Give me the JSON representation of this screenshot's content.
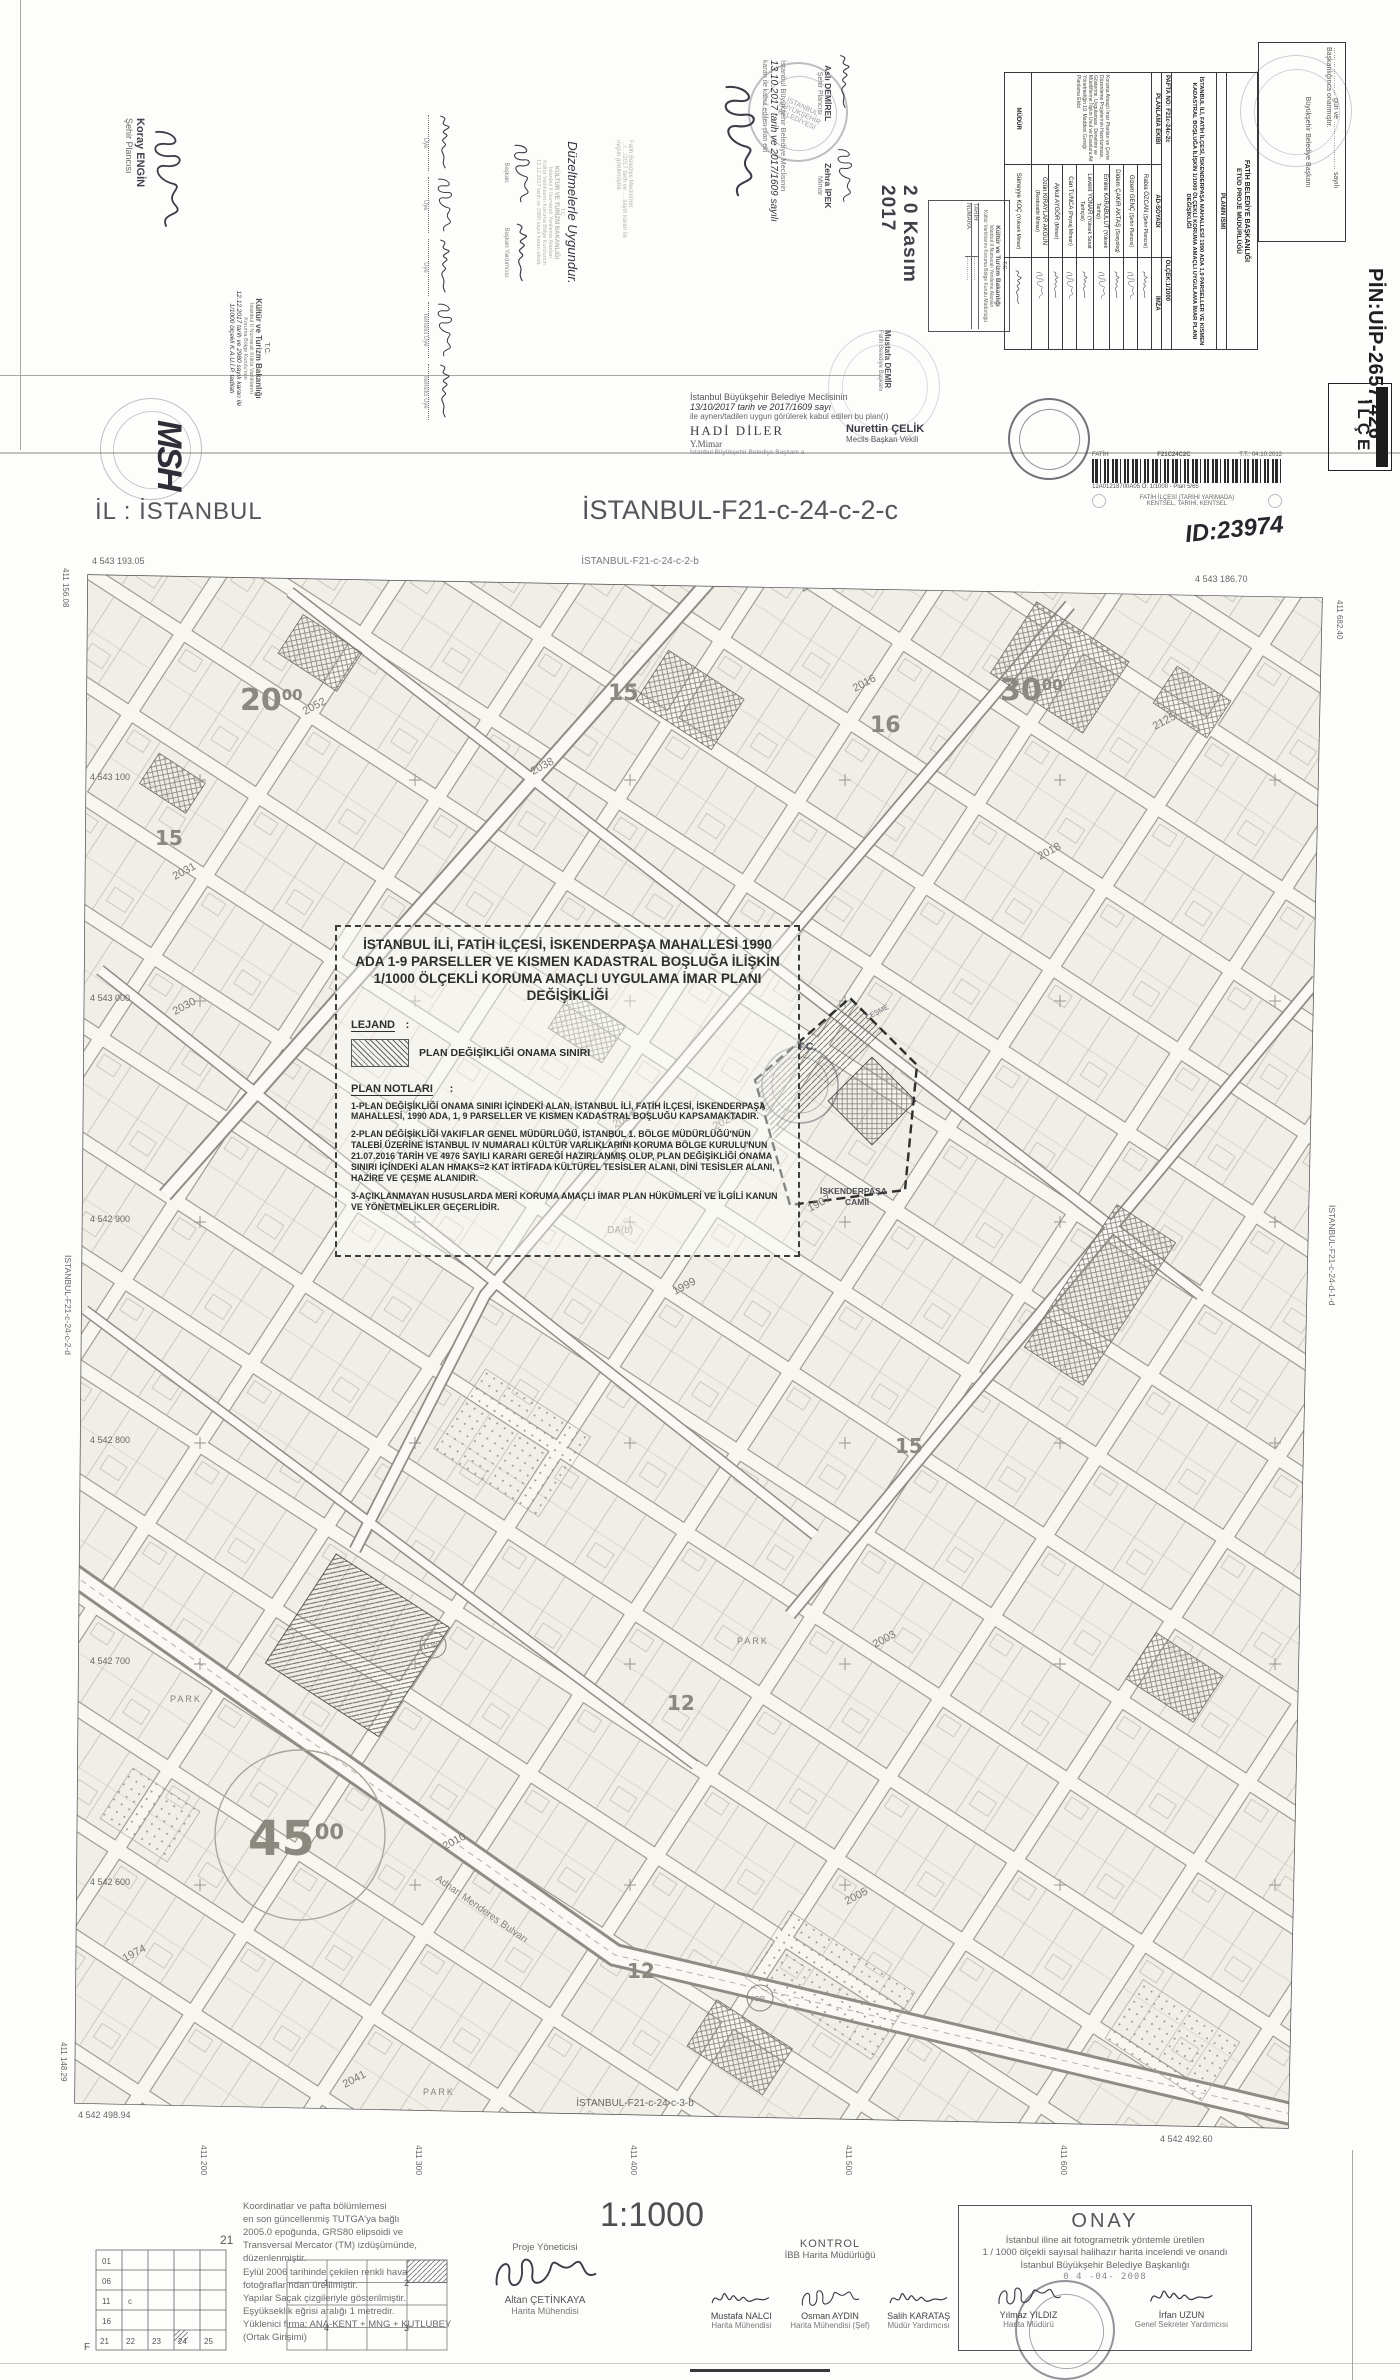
{
  "accent": {
    "ink": "#3c3c48",
    "stamp_gray": "#6b6b78",
    "line": "#444444"
  },
  "top_left": {
    "koray_name": "Koray ENGİN",
    "koray_title": "Şehir Plancısı",
    "monogram": "MSH",
    "kultur": {
      "tc": "T.C.",
      "l1": "Kültür ve Turizm Bakanlığı",
      "l2": "İstanbul II Numaralı Kültür Varlıklarını",
      "l3": "Koruma Bölge Kurulu'nun",
      "hand1": "12.12.2017 tarih ve 2980 sayılı kararı ile",
      "hand2": "1/1000 ölçekli K.A.U.İ.P. tadilatı"
    },
    "uye_labels": [
      "Üye",
      "Üye",
      "Üye",
      "Temsilci Üye",
      "Temsilci Üye"
    ],
    "duzeltme": {
      "hand": "Düzeltmelerle Uygundur.",
      "s1": "T.C.",
      "s2": "KÜLTÜR VE TURİZM BAKANLIĞI",
      "s3": "İstanbul II Numaralı Yenileme Alanları",
      "s4": "Kültür Varlıklarını Koruma Bölge Kurulunun",
      "s5": "12.12.2017 tarih ve 2980 sayılı kararı ekidir.",
      "sig1": "Başkan",
      "sig2": "Başkan Yardımcısı"
    },
    "fatih_faint": [
      "Fatih Belediye Meclisi'nin",
      "…/…/2017 tarih ve … sayılı kararı ile",
      "uygun görülmüştür."
    ]
  },
  "center_stamps": {
    "ibb1": "İstanbul Büyükşehir Belediye Meclisinin",
    "ibb2": "13.10.2017 tarih ve 2017/1609 sayılı",
    "ibb3": "kararı ile kabul edilen plan eki",
    "ibb_round": "İSTANBUL BÜYÜKŞEHİR BELEDİYESİ",
    "asli_name": "Aslı DEMİREL",
    "asli_title": "Şehir Plancısı",
    "zehra_name": "Zehra İPEK",
    "zehra_title": "Mimar",
    "date_stamp": "2 0 Kasım 2017",
    "kurul_box": {
      "tc": "T.C.",
      "l1": "Kültür ve Turizm Bakanlığı",
      "l2": "İstanbul II Numaralı Yenileme Alanları",
      "l3": "Kültür Varlıklarını Koruma Bölge Kurulu Müdürlüğü",
      "tarih": "TARİH",
      "numara": "NUMARA"
    },
    "mustafa": "Mustafa DEMİR",
    "mustafa_title": "Fatih Belediye Başkanı",
    "below_fold": {
      "l1": "İstanbul Büyükşehir Belediye Meclisinin",
      "l2": "13/10/2017 tarih ve 2017/1609 sayı",
      "l3": "ile aynen/tadilen uygun görülerek kabul edilen bu plan(ı)",
      "name1": "HADİ DİLER",
      "title1": "Y.Mimar",
      "sub1": "İstanbul Büyükşehir Belediye Başkanı a.",
      "name2": "Nurettin ÇELİK",
      "title2": "Meclis Başkan Vekili"
    }
  },
  "top_right": {
    "onama_box": {
      "l1": "………………… gün ve ………………… sayılı",
      "l2": "Başkanlığınca onanmıştır.",
      "l3": "Büyükşehir Belediye Başkanı"
    },
    "pin": "PİN:UİP-2657,426",
    "ilce": "İLÇE",
    "barcode": {
      "left": "FATİH",
      "code": "F21C24C2C",
      "tt": "T.T.: 04.10.2012",
      "sub": "12A01218700A05   Ö: 1/1000 - Plan   5/65",
      "b1": "FATİH İLÇESİ (TARİHİ YARIMADA)",
      "b2": "KENTSEL, TARİHİ, KENTSEL"
    },
    "hand_id": "ID:23974"
  },
  "table": {
    "header1": "FATİH BELEDİYE BAŞKANLIĞI",
    "header2": "ETÜD PROJE MÜDÜRLÜĞÜ",
    "plan_ismi_label": "PLANIN İSMİ",
    "plan_ismi": "İSTANBUL İLİ, FATİH İLÇESİ, İSKENDERPAŞA MAHALLESİ 1990 ADA 1,9 PARSELLER VE KISMEN KADASTRAL BOŞLUĞA İLİŞKİN 1/1000 ÖLÇEKLİ KORUMA AMAÇLI UYGULAMA İMAR PLANI DEĞİŞİKLİĞİ",
    "pafta": "PAFTA NO: F21c-24c-2c",
    "olcek": "ÖLÇEK:1/1000",
    "col_ekip": "PLANLAMA EKİBİ",
    "col_ad": "AD-SOYADI",
    "col_imza": "İMZA",
    "ekip_aciklama": "Koruma Amaçlı İmar Planları ve Çevre Düzenleme Projelerinin Hazırlanması, Gösterimi, Uygulaması, Denetimi ve Müelliflerine İlişkin Usul ve Esaslara Ait Yönetmeliğin 19. Maddesi Gereği Planlama Ekibi",
    "rows": [
      {
        "name": "Rabia ÖZCAN",
        "title": "(Şehir Plancısı)"
      },
      {
        "name": "Gizem GENÇ",
        "title": "(Şehir Plancısı)"
      },
      {
        "name": "Didem ÇAKIR AKTAŞ",
        "title": "(Sosyolog)"
      },
      {
        "name": "Emine KARABULUT",
        "title": "(Yüksek Tarihçi)"
      },
      {
        "name": "Levent YONAR",
        "title": "(Yüksek Sanat Tarihçisi)"
      },
      {
        "name": "Can TUNCA",
        "title": "(Peyzaj Mimarı)"
      },
      {
        "name": "Aykut AYGÖR",
        "title": "(Mimar)"
      },
      {
        "name": "Özün KIRAYLAR AKGÜN",
        "title": "(Restoratör Mimar)"
      }
    ],
    "mudur_label": "MÜDÜR",
    "mudur_name": "Sümeyye KOÇ",
    "mudur_title": "(Yüksek Mimar)"
  },
  "map": {
    "il_label": "İL : İSTANBUL",
    "sheet_title": "İSTANBUL-F21-c-24-c-2-c",
    "north_sheet": "İSTANBUL-F21-c-24-c-2-b",
    "south_sheet": "İSTANBUL-F21-c-24-c-3-b",
    "west_sheet": "İSTANBUL-F21-c-24-c-2-d",
    "east_sheet": "İSTANBUL-F21-c-24-d-1-d",
    "tl_coord": "4 543 193.05",
    "tl_easting": "411 156.08",
    "tr_coord": "4 543 186.70",
    "tr_easting": "411 682.40",
    "bl_coord": "4 542 498.94",
    "bl_easting": "411 148.29",
    "br_coord": "4 542 492.60",
    "northing_labels": [
      "4 543 100",
      "4 543 000",
      "4 542 900",
      "4 542 800",
      "4 542 700",
      "4 542 600"
    ],
    "easting_labels": [
      "411 200",
      "411 300",
      "411 400",
      "411 500",
      "411 600"
    ],
    "block_labels": [
      "2052",
      "2038",
      "2013",
      "2031",
      "2030",
      "2021",
      "2020",
      "1999",
      "2018",
      "2016",
      "2125",
      "1907",
      "2003",
      "2005",
      "2010",
      "2041",
      "1974"
    ],
    "big_labels": [
      {
        "n": "20",
        "s": "00"
      },
      {
        "n": "30",
        "s": "00"
      },
      {
        "n": "45",
        "s": "00"
      },
      {
        "n": "15"
      },
      {
        "n": "16"
      },
      {
        "n": "15"
      },
      {
        "n": "12"
      },
      {
        "n": "12"
      },
      {
        "n": "15"
      }
    ],
    "poi": {
      "tc": "T.C.",
      "mosque1": "İSKENDERPAŞA",
      "mosque2": "CAMİİ",
      "cesme": "ÇEŞME",
      "park": "PARK",
      "yop": "YOP",
      "dab": "DA(b)",
      "street": "Adnan Menderes Bulvarı"
    }
  },
  "panel": {
    "title": "İSTANBUL İLİ, FATİH İLÇESİ, İSKENDERPAŞA MAHALLESİ 1990 ADA 1-9 PARSELLER VE KISMEN KADASTRAL BOŞLUĞA İLİŞKİN 1/1000 ÖLÇEKLİ KORUMA AMAÇLI UYGULAMA İMAR PLANI DEĞİŞİKLİĞİ",
    "lejand_label": "LEJAND",
    "lejand_item": "PLAN DEĞİŞİKLİĞİ ONAMA SINIRI",
    "notlar_label": "PLAN NOTLARI",
    "not1": "1-PLAN DEĞİŞİKLİĞİ ONAMA SINIRI İÇİNDEKİ ALAN, İSTANBUL İLİ, FATİH İLÇESİ, İSKENDERPAŞA MAHALLESİ, 1990 ADA, 1, 9 PARSELLER VE KISMEN KADASTRAL BOŞLUĞU KAPSAMAKTADIR.",
    "not2": "2-PLAN DEĞİŞİKLİĞİ VAKIFLAR GENEL MÜDÜRLÜĞÜ, İSTANBUL 1. BÖLGE MÜDÜRLÜĞÜ'NÜN TALEBİ ÜZERİNE İSTANBUL IV NUMARALI KÜLTÜR VARLIKLARINI KORUMA BÖLGE KURULU'NUN 21.07.2016 TARİH VE 4976 SAYILI KARARI GEREĞİ HAZIRLANMIŞ OLUP, PLAN DEĞİŞİKLİĞİ ONAMA SINIRI İÇİNDEKİ ALAN HMAKS=2 KAT İRTİFADA KÜLTÜREL TESİSLER ALANI, DİNİ TESİSLER ALANI, HAZİRE VE ÇEŞME ALANIDIR.",
    "not3": "3-AÇIKLANMAYAN HUSUSLARDA MERİ KORUMA AMAÇLI İMAR PLAN HÜKÜMLERİ VE İLGİLİ KANUN VE YÖNETMELİKLER GEÇERLİDİR."
  },
  "bottom": {
    "scale": "1:1000",
    "proje_label": "Proje Yöneticisi",
    "altan_name": "Altan ÇETİNKAYA",
    "altan_title": "Harita Mühendisi",
    "kontrol_label": "KONTROL",
    "kontrol_sub": "İBB Harita Müdürlüğü",
    "sig1_name": "Mustafa NALCI",
    "sig1_title": "Harita Mühendisi",
    "sig2_name": "Osman AYDIN",
    "sig2_title": "Harita Mühendisi (Şef)",
    "sig3_name": "Salih KARATAŞ",
    "sig3_title": "Müdür Yardımcısı",
    "onay_title": "ONAY",
    "onay_l1": "İstanbul iline ait fotogrametrik yöntemle üretilen",
    "onay_l2": "1 / 1000 ölçekli sayısal halihazır harita incelendi ve onandı",
    "onay_l3": "İstanbul Büyükşehir Belediye Başkanlığı",
    "onay_date": "0 4 -04- 2008",
    "onay_sig1": "Yılmaz YILDIZ",
    "onay_sig1_title": "Harita Müdürü",
    "onay_sig2": "İrfan UZUN",
    "onay_sig2_title": "Genel Sekreter Yardımcısı",
    "notes": [
      "Koordinatlar ve pafta bölümlemesi",
      "en son güncellenmiş TUTGA'ya bağlı",
      "2005.0 epoğunda, GRS80 elipsoidi ve",
      "Transversal Mercator (TM) izdüşümünde,",
      "düzenlenmiştir.",
      "Eylül 2006 tarihinde çekilen renkli hava",
      "fotoğraflarından üretilmiştir.",
      "Yapılar Saçak çizgileriyle gösterilmiştir.",
      "Eşyükseklik eğrisi aralığı 1 metredir.",
      "Yüklenici firma: ANA-KENT + MNG + KUTLUBEY",
      "(Ortak Girişimi)"
    ],
    "grid_top": "21",
    "grid_f": "F",
    "grid_c": "c",
    "grid_rows": [
      "01",
      "06",
      "11",
      "16",
      "21"
    ],
    "grid_cols": [
      "21",
      "22",
      "23",
      "24",
      "25"
    ],
    "mini_cells": [
      "1",
      "2",
      "4",
      "3"
    ]
  }
}
